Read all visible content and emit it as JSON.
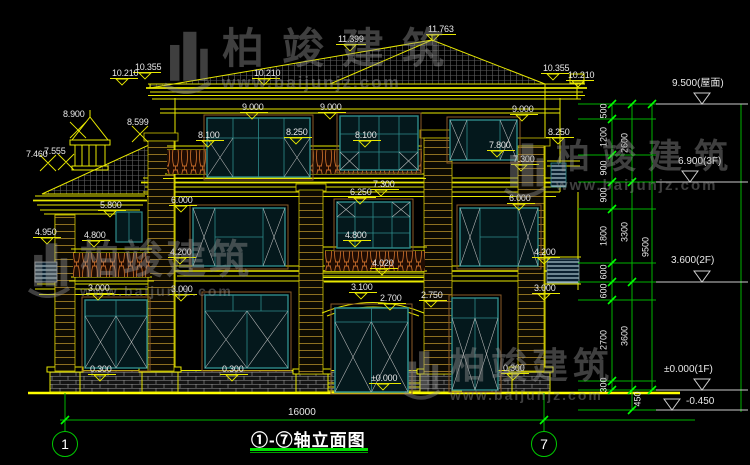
{
  "watermark": {
    "brand": "柏竣建筑",
    "url": "www.baijunjz.com"
  },
  "title_block": {
    "title": "①-⑦轴立面图",
    "overall_dim": "16000",
    "axis_start": "1",
    "axis_end": "7"
  },
  "levels": [
    "9.500(屋面)",
    "6.900(3F)",
    "3.600(2F)",
    "±0.000(1F)",
    "-0.450"
  ],
  "dims": {
    "inner": [
      "500",
      "1200",
      "900",
      "900",
      "1800",
      "600",
      "600",
      "2700",
      "300"
    ],
    "middle": [
      "2600",
      "3300",
      "3600",
      "450"
    ],
    "overall": "9500"
  },
  "spot_elevations": [
    "11.399",
    "11.763",
    "10.210",
    "10.355",
    "10.210",
    "10.355",
    "10.210",
    "8.900",
    "8.599",
    "9.000",
    "9.000",
    "9.000",
    "8.100",
    "8.250",
    "8.100",
    "8.250",
    "7.800",
    "7.460",
    "7.555",
    "7.300",
    "7.300",
    "6.250",
    "6.000",
    "6.000",
    "5.800",
    "4.950",
    "4.800",
    "4.800",
    "4.200",
    "4.200",
    "4.020",
    "3.000",
    "3.000",
    "3.000",
    "3.100",
    "2.700",
    "2.750",
    "0.300",
    "0.300",
    "0.300",
    "±0.000"
  ]
}
